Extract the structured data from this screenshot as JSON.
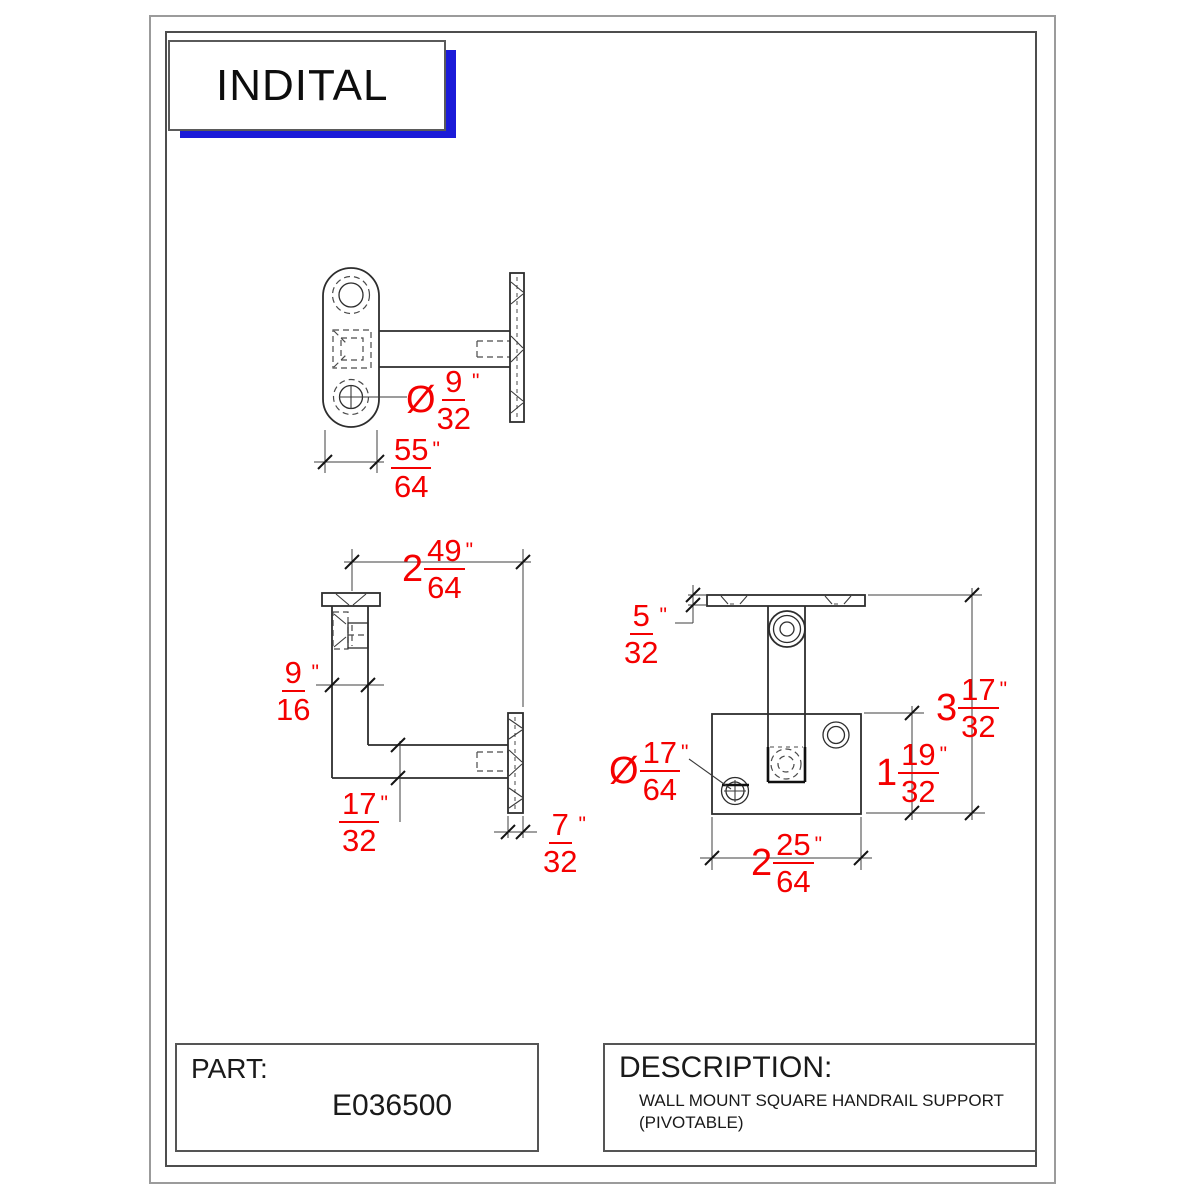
{
  "logo": {
    "text": "INDITAL"
  },
  "title_block": {
    "part_label": "PART:",
    "part_number": "E036500",
    "description_label": "DESCRIPTION:",
    "description_lines": [
      "WALL MOUNT SQUARE HANDRAIL SUPPORT",
      "(PIVOTABLE)"
    ]
  },
  "dims": {
    "hole_dia_top": {
      "lead": "Ø",
      "num": "9",
      "den": "32",
      "unit": "\""
    },
    "plate_width_top": {
      "num": "55",
      "den": "64",
      "unit": "\""
    },
    "reach": {
      "lead": "2",
      "num": "49",
      "den": "64",
      "unit": "\""
    },
    "arm_width": {
      "num": "9",
      "den": "16",
      "unit": "\""
    },
    "arm_thickness": {
      "num": "17",
      "den": "32",
      "unit": "\""
    },
    "flange_thickness": {
      "num": "7",
      "den": "32",
      "unit": "\""
    },
    "saddle_thickness": {
      "num": "5",
      "den": "32",
      "unit": "\""
    },
    "overall_height": {
      "lead": "3",
      "num": "17",
      "den": "32",
      "unit": "\""
    },
    "plate_height": {
      "lead": "1",
      "num": "19",
      "den": "32",
      "unit": "\""
    },
    "mount_hole_dia": {
      "lead": "Ø",
      "num": "17",
      "den": "64",
      "unit": "\""
    },
    "plate_width_front": {
      "lead": "2",
      "num": "25",
      "den": "64",
      "unit": "\""
    }
  },
  "colors": {
    "dimension_red": "#f40000",
    "logo_blue": "#1b1bd8",
    "line_dark": "#2d2d2d"
  }
}
